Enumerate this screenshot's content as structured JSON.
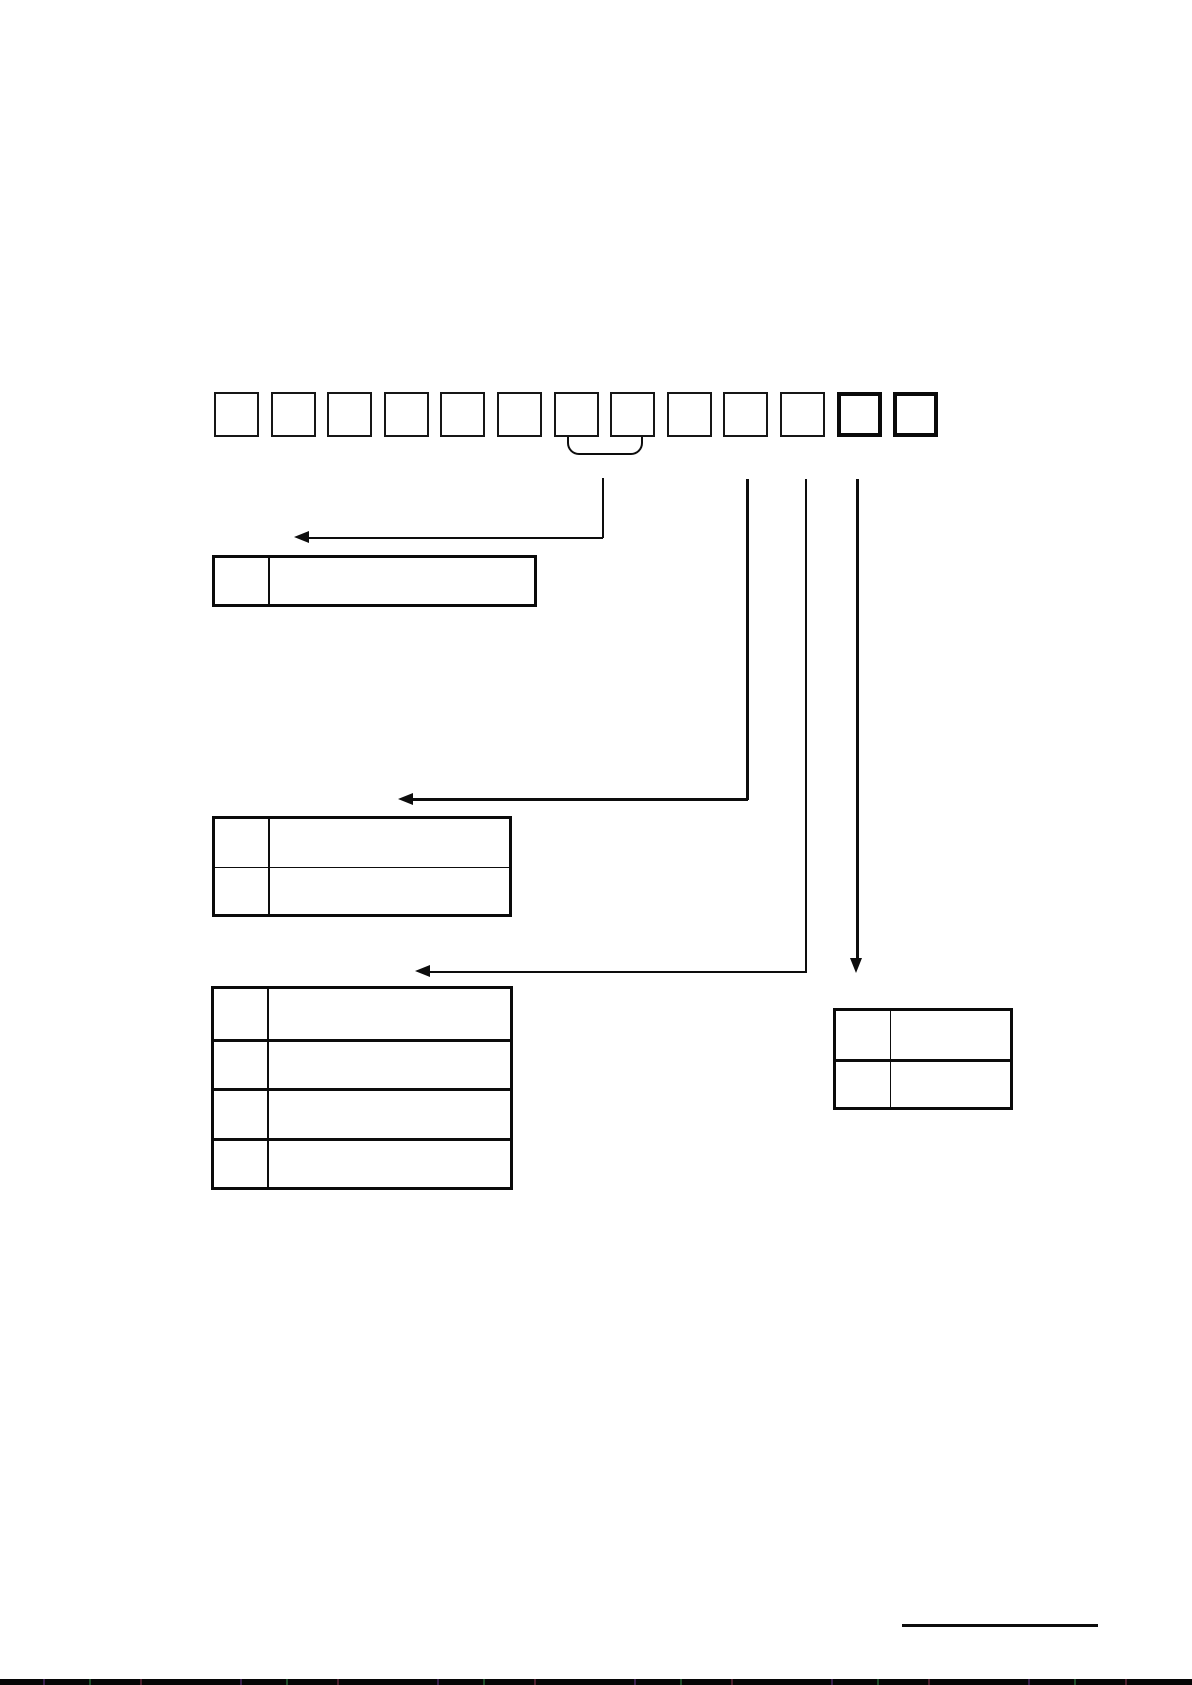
{
  "page": {
    "description": "Scanned manual page: model-number code breakdown diagram with a row of empty code boxes, a grouping brace, connector arrows and four empty option tables",
    "background_color": "#ffffff",
    "ink_color": "#0d0d0d",
    "code_row": {
      "box_count": 13,
      "bold_box_positions": [
        12,
        13
      ],
      "brace_grouped_boxes": [
        7,
        8
      ]
    },
    "tables": [
      {
        "id": "option-table-1",
        "rows": 1,
        "columns": 2
      },
      {
        "id": "option-table-2",
        "rows": 2,
        "columns": 2
      },
      {
        "id": "option-table-3",
        "rows": 4,
        "columns": 2
      },
      {
        "id": "option-table-4",
        "rows": 2,
        "columns": 2
      }
    ],
    "arrows": [
      {
        "from": "brace under boxes 7-8",
        "to": "option-table-1",
        "direction": "left"
      },
      {
        "from": "box 10",
        "to": "option-table-2",
        "direction": "left"
      },
      {
        "from": "box 11",
        "to": "option-table-3",
        "direction": "left"
      },
      {
        "from": "box 12",
        "to": "option-table-4",
        "direction": "down"
      }
    ],
    "footer": {
      "underline_present": true,
      "bottom_scan_edge_present": true
    }
  }
}
